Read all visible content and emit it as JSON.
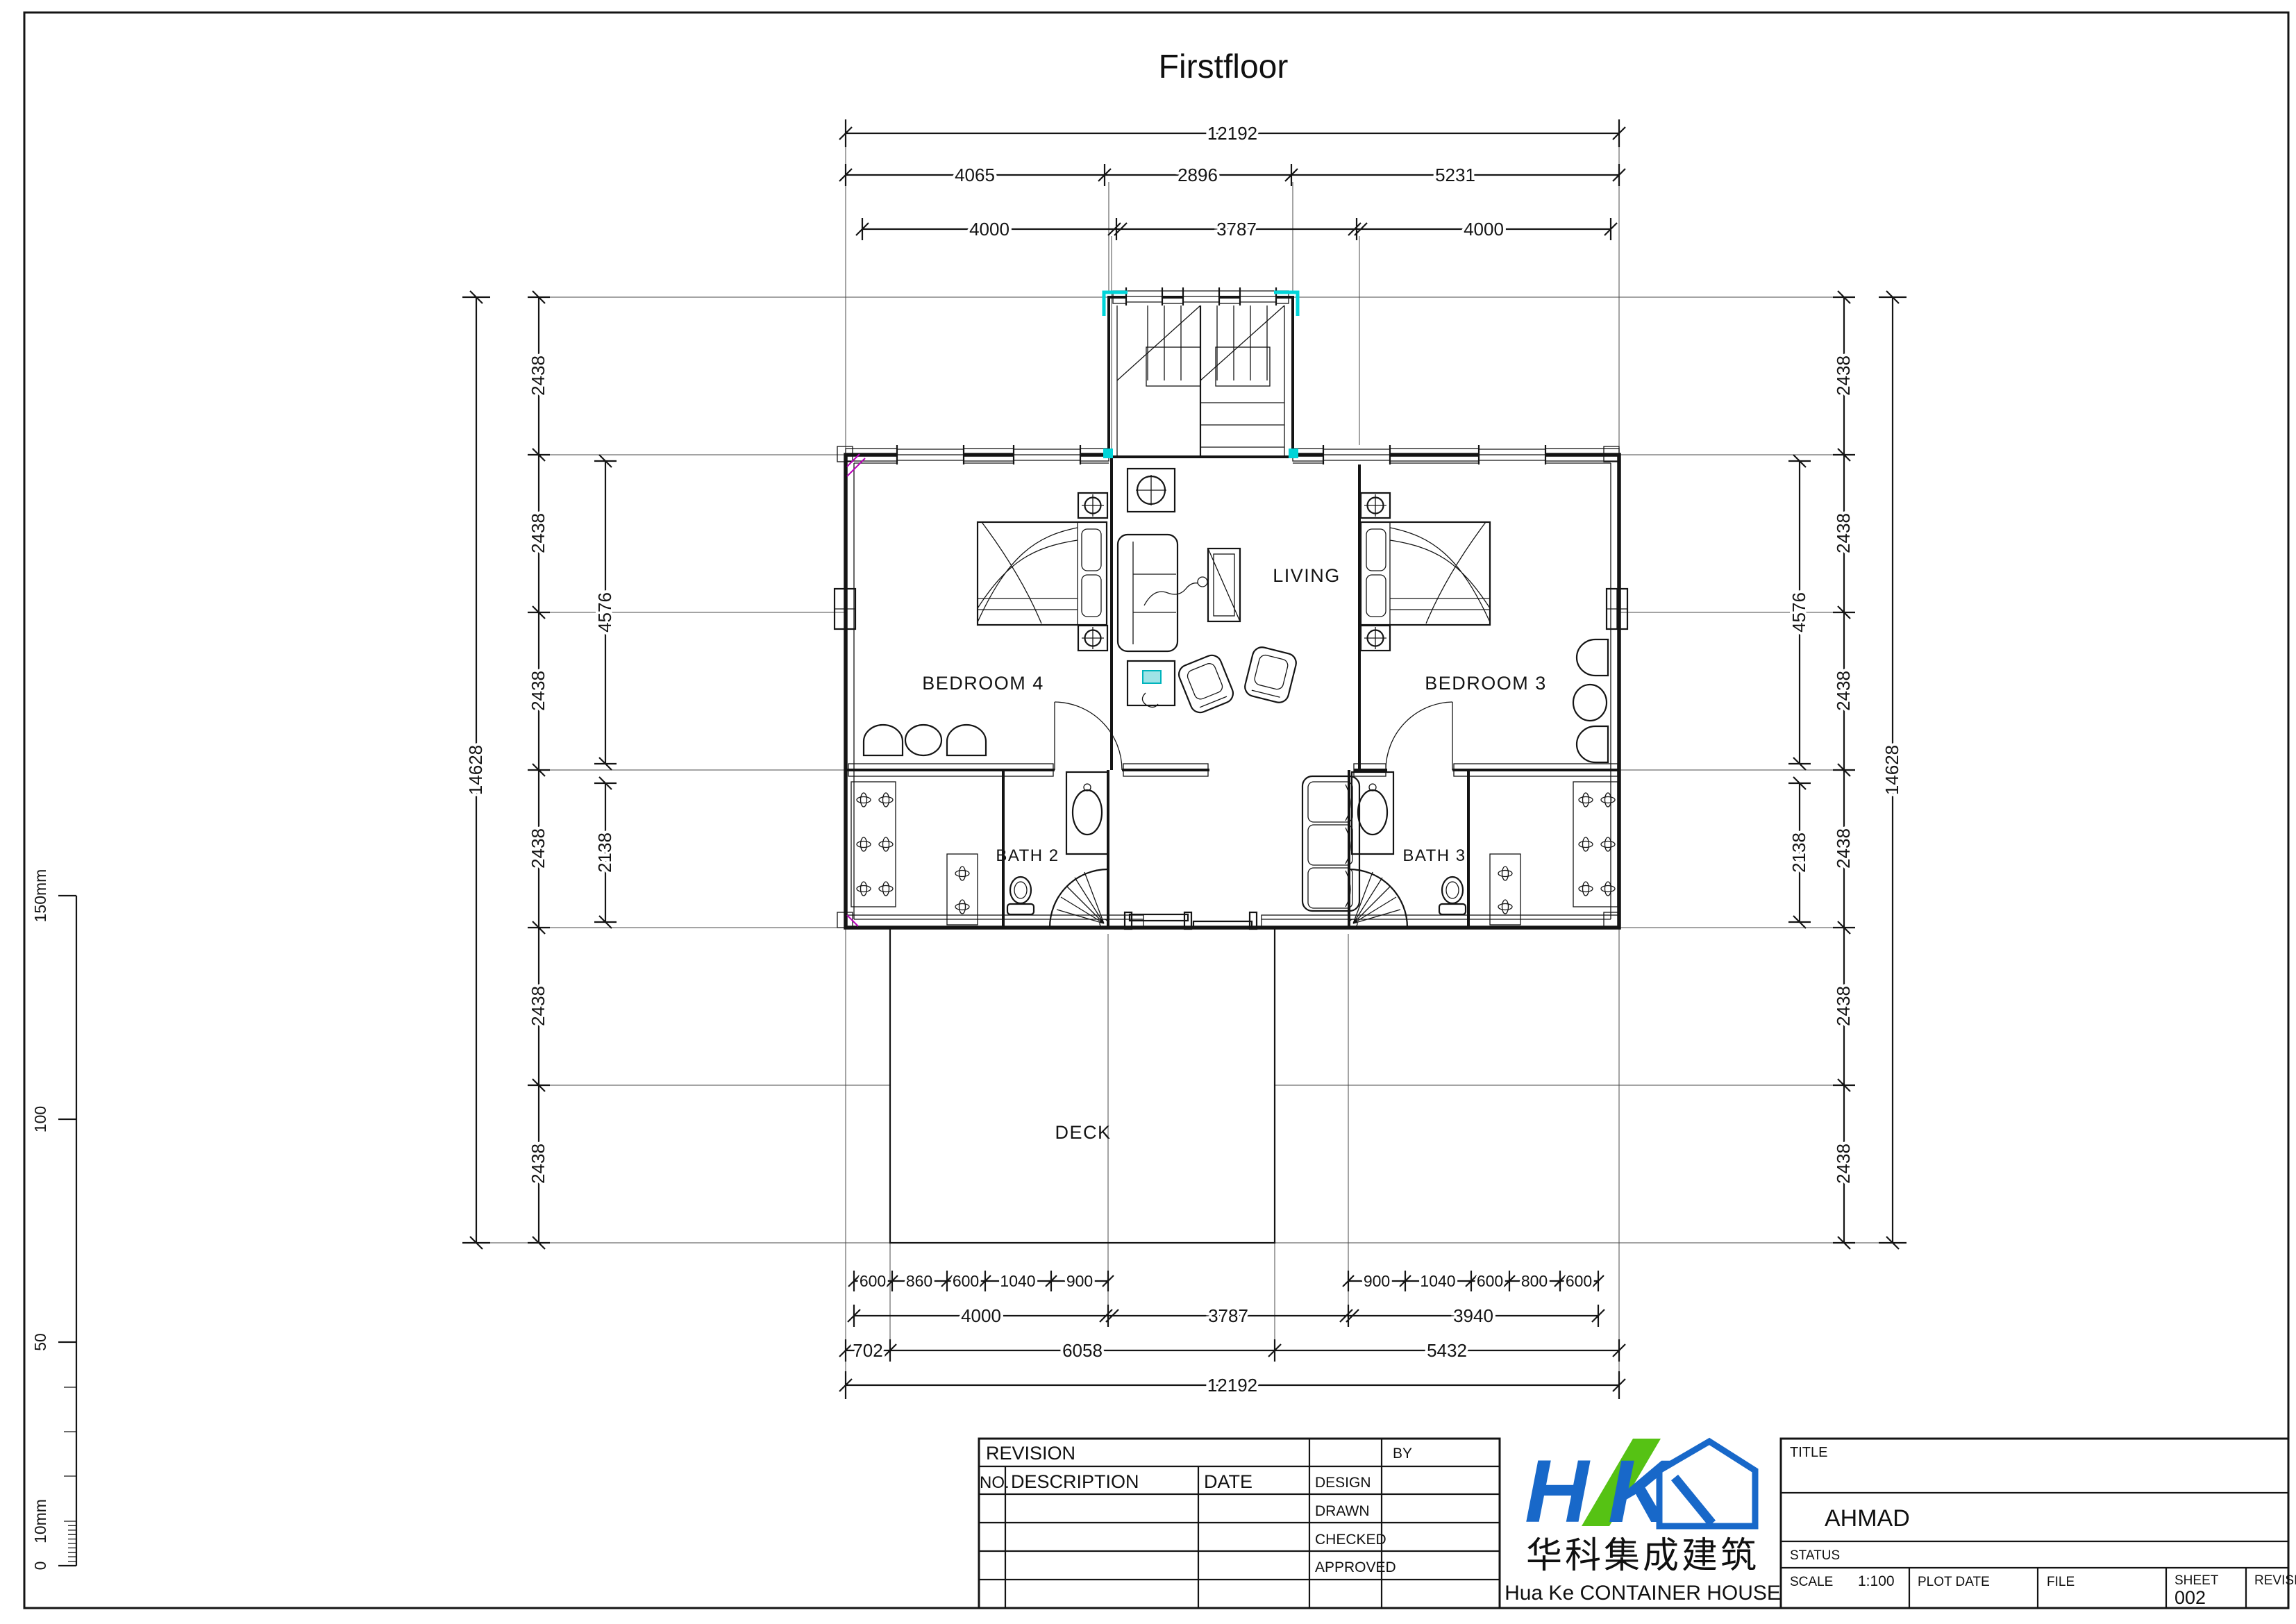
{
  "page": {
    "title": "Firstfloor"
  },
  "rooms": {
    "living": "LIVING",
    "bedroom4": "BEDROOM 4",
    "bedroom3": "BEDROOM 3",
    "bath2": "BATH 2",
    "bath3": "BATH 3",
    "deck": "DECK"
  },
  "dims": {
    "top": {
      "overall": "12192",
      "row2": [
        "4065",
        "2896",
        "5231"
      ],
      "row3": [
        "4000",
        "3787",
        "4000"
      ]
    },
    "bottom": {
      "small_left": [
        "600",
        "860",
        "600",
        "1040",
        "900"
      ],
      "small_right": [
        "900",
        "1040",
        "600",
        "800",
        "600"
      ],
      "mid": [
        "4000",
        "3787",
        "3940"
      ],
      "row3": [
        "702",
        "6058",
        "5432"
      ],
      "overall": "12192"
    },
    "left": {
      "overall": "14628",
      "modules": [
        "2438",
        "2438",
        "2438",
        "2438",
        "2438",
        "2438"
      ],
      "upper": "4576",
      "lower": "2138"
    },
    "right": {
      "overall": "14628",
      "modules": [
        "2438",
        "2438",
        "2438",
        "2438",
        "2438",
        "2438"
      ],
      "upper": "4576",
      "lower": "2138"
    }
  },
  "ruler": {
    "l0": "0",
    "l10": "10mm",
    "l50": "50",
    "l100": "100",
    "l150": "150mm"
  },
  "revision": {
    "header": "REVISION",
    "by": "BY",
    "no": "NO.",
    "description": "DESCRIPTION",
    "date": "DATE",
    "design": "DESIGN",
    "drawn": "DRAWN",
    "checked": "CHECKED",
    "approved": "APPROVED"
  },
  "titleblock": {
    "title_label": "TITLE",
    "project": "AHMAD",
    "status_label": "STATUS",
    "scale_label": "SCALE",
    "scale_value": "1:100",
    "plot_date": "PLOT DATE",
    "file": "FILE",
    "sheet_label": "SHEET",
    "sheet_number": "002",
    "revision_label": "REVISION"
  },
  "company": {
    "name_cn": "华科集成建筑",
    "name_en": "Hua Ke CONTAINER HOUSE"
  },
  "colors": {
    "ink": "#141414",
    "cyan": "#00d4d8",
    "magenta": "#b800b8",
    "logo_blue": "#1868c9",
    "logo_green": "#56c214"
  }
}
